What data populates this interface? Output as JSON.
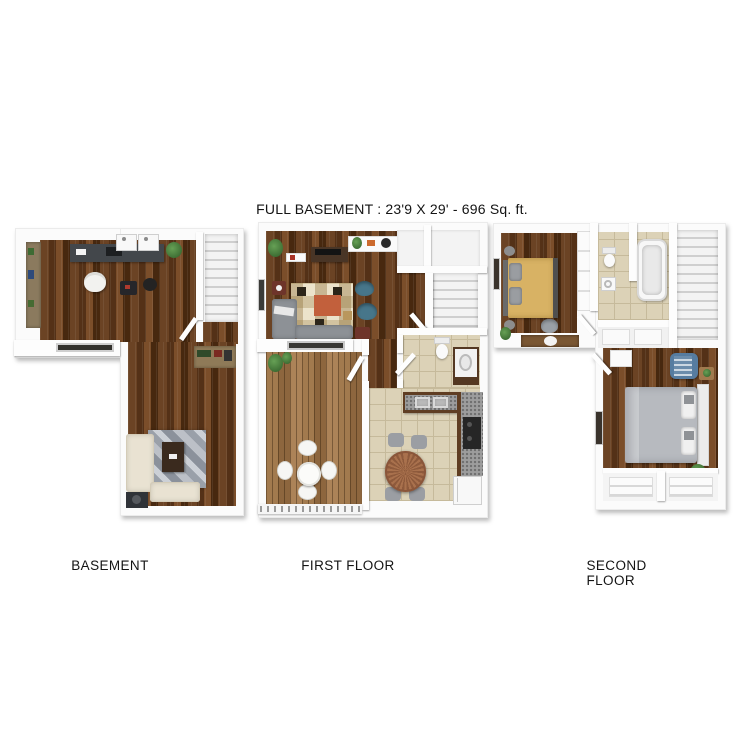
{
  "title": "FULL BASEMENT : 23'9 X 29' - 696 Sq. ft.",
  "plans": [
    {
      "id": "basement",
      "label": "BASEMENT"
    },
    {
      "id": "first-floor",
      "label": "FIRST FLOOR"
    },
    {
      "id": "second-floor",
      "label": "SECOND FLOOR"
    }
  ],
  "colors": {
    "background": "#ffffff",
    "text": "#141414",
    "wall_white": "#fbfbfb",
    "wood_floor_dark": "#5e3a1f",
    "deck_wood": "#9c754a",
    "kitchen_tile": "#dcd2b7",
    "granite_counter": "#9d9d9d",
    "counter_wood": "#5f3d22",
    "rug_gray": "#9aa0a9",
    "rug_checker_beige": "#ece3cb",
    "sofa_cream": "#e9e2d2",
    "sofa_gray": "#8d9196",
    "coffee_table_orange": "#c2603c",
    "accent_teal_chair": "#47768a",
    "bed_tan": "#d8b264",
    "bed_gray": "#b7babf",
    "armchair_blue": "#567ca0",
    "plant_green": "#3f7a37",
    "window_glass": "#3a3935"
  }
}
